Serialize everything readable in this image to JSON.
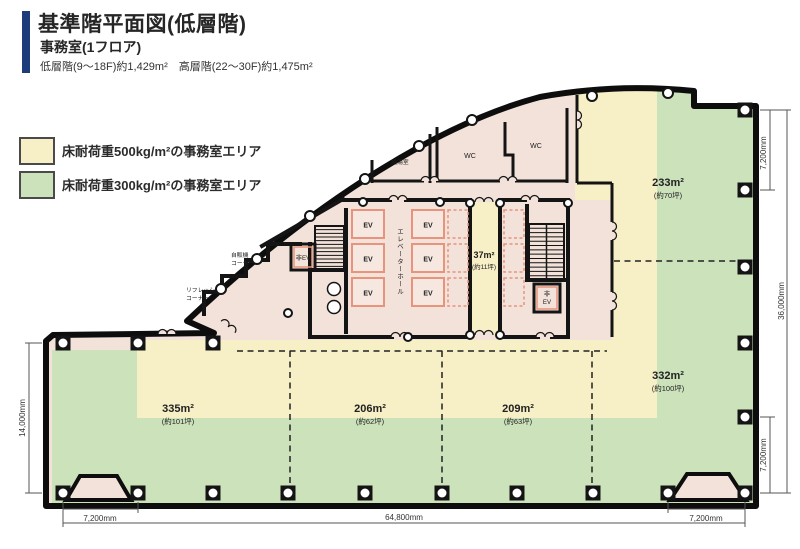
{
  "header": {
    "title": "基準階平面図(低層階)",
    "subtitle": "事務室(1フロア)",
    "specs": "低層階(9〜18F)約1,429m²　高層階(22〜30F)約1,475m²"
  },
  "legend": {
    "item_500": "床耐荷重500kg/m²の事務室エリア",
    "item_300": "床耐荷重300kg/m²の事務室エリア"
  },
  "plan": {
    "rooms": {
      "kitchen": "給湯室",
      "wc": "WC",
      "ev": "EV",
      "ev_hall": "エレベーターホール",
      "emergency_ev": "非EV",
      "emergency_ev_l1": "非",
      "emergency_ev_l2": "EV",
      "vending_l1": "自販機",
      "vending_l2": "コーナー",
      "refresh_l1": "リフレッシュ",
      "refresh_l2": "コーナー"
    },
    "areas": {
      "a233": {
        "value": "233m²",
        "tsubo": "(約70坪)"
      },
      "a37": {
        "value": "37m²",
        "tsubo": "(約11坪)"
      },
      "a332": {
        "value": "332m²",
        "tsubo": "(約100坪)"
      },
      "a335": {
        "value": "335m²",
        "tsubo": "(約101坪)"
      },
      "a206": {
        "value": "206m²",
        "tsubo": "(約62坪)"
      },
      "a209": {
        "value": "209m²",
        "tsubo": "(約63坪)"
      }
    },
    "dimensions": {
      "right_top": "7,200mm",
      "right_total": "36,000mm",
      "right_bottom": "7,200mm",
      "left": "14,000mm",
      "bottom_left": "7,200mm",
      "bottom_total": "64,800mm",
      "bottom_right": "7,200mm"
    }
  },
  "colors": {
    "area_500kg": "#F7EFC5",
    "area_300kg": "#CBE2BB",
    "common_area": "#F2E2D9",
    "accent_bar": "#1C3D7A",
    "ev_outline": "#E8937C",
    "wall": "#141414"
  }
}
